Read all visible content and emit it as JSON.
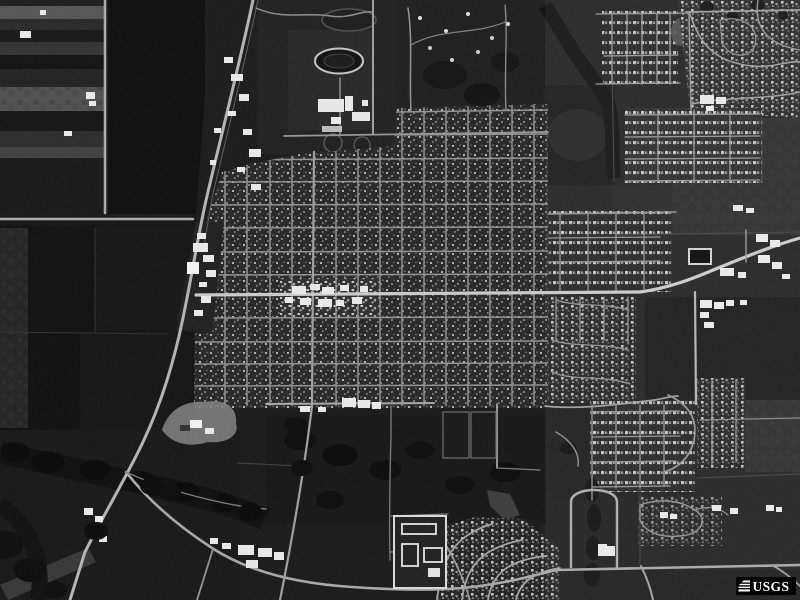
{
  "watermark": {
    "label": "USGS",
    "icon": "usgs-stripes-icon",
    "bg": "#000000",
    "fg": "#ffffff"
  },
  "photo": {
    "kind": "grayscale-aerial-photograph",
    "features": [
      "farm-fields-west",
      "rail-corridor-diagonal",
      "town-street-grid",
      "main-street",
      "school-campus-running-track",
      "northeast-subdivisions",
      "east-subdivisions",
      "creek-treeline-southwest",
      "quarry-gravel-pit",
      "apartment-complex",
      "curved-subdivision-streets",
      "u-shaped-loop-road",
      "highway-junction-southwest"
    ]
  },
  "palette": {
    "field_dark": "#0b0b0b",
    "field_mid": "#1c1c1c",
    "road_bright": "#c8c8c8",
    "road_mid": "#9b9b9b",
    "building_white": "#e8e8e8",
    "tree_dark": "#0a0a0a"
  }
}
